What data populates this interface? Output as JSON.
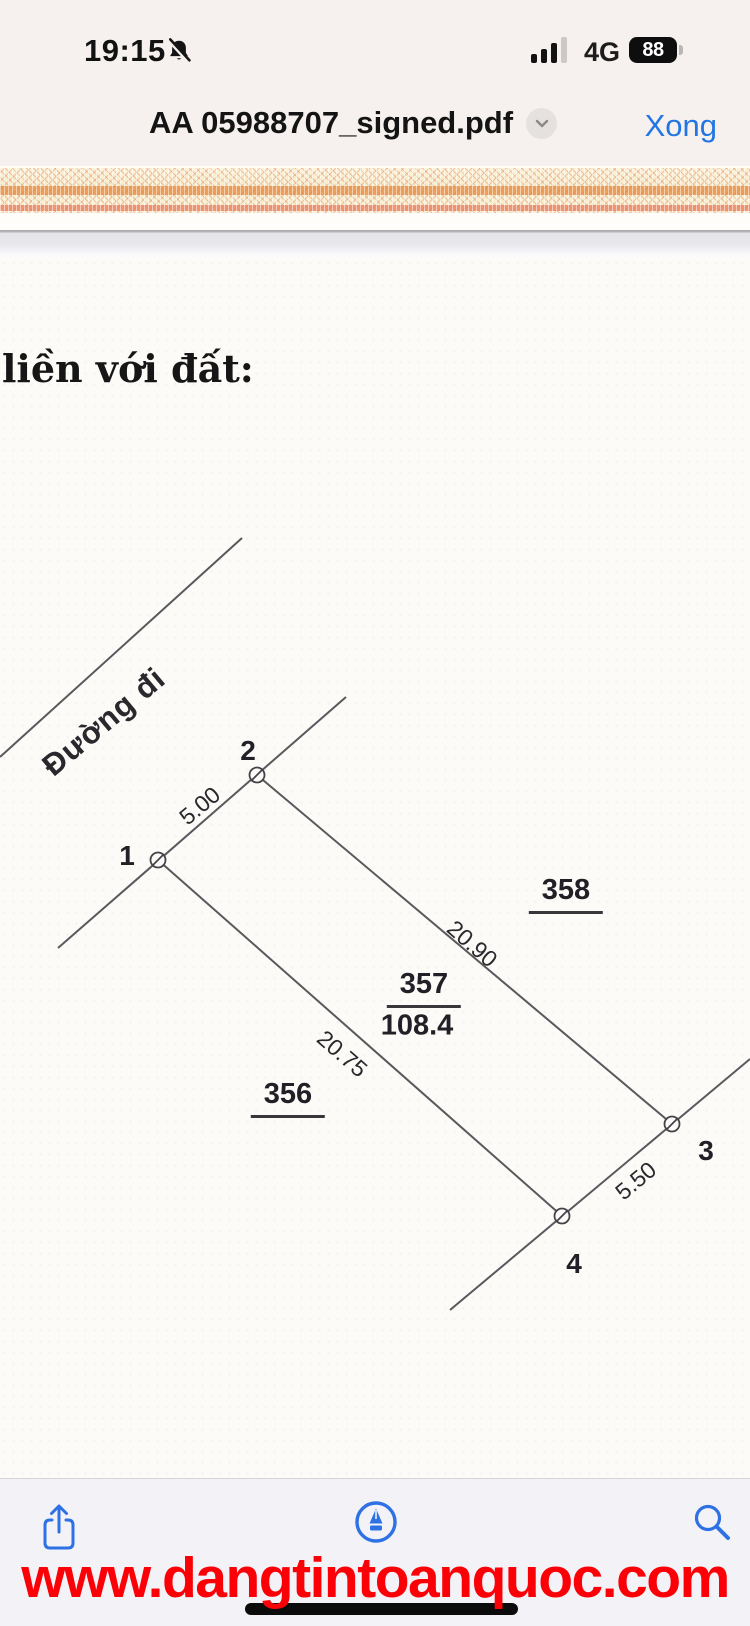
{
  "status_bar": {
    "time": "19:15",
    "network": "4G",
    "battery_percent": "88",
    "icons": [
      "bell-slash-icon",
      "signal-strength-icon",
      "battery-icon"
    ]
  },
  "title_bar": {
    "filename": "AA 05988707_signed.pdf",
    "done_label": "Xong",
    "icons": [
      "chevron-down-icon"
    ]
  },
  "document": {
    "heading": "liền với đất:",
    "road_label": "Đường đi",
    "vertices": [
      {
        "label": "1"
      },
      {
        "label": "2"
      },
      {
        "label": "3"
      },
      {
        "label": "4"
      }
    ],
    "dimensions": {
      "side_1_2": "5.00",
      "side_2_3": "20.90",
      "side_1_4": "20.75",
      "side_4_3": "5.50"
    },
    "parcels": {
      "left_number": "356",
      "center_number": "357",
      "center_area": "108.4",
      "right_number": "358"
    }
  },
  "toolbar": {
    "icons": [
      "share-icon",
      "markup-icon",
      "search-icon"
    ]
  },
  "watermark": {
    "url": "www.dangtintoanquoc.com"
  },
  "colors": {
    "accent_blue": "#2276e4",
    "watermark_red": "#fb0007",
    "header_background": "#f6f1ee",
    "toolbar_background": "#f3f2f7",
    "deco_orange": "#eba05b",
    "deco_pink": "#ec9678"
  }
}
